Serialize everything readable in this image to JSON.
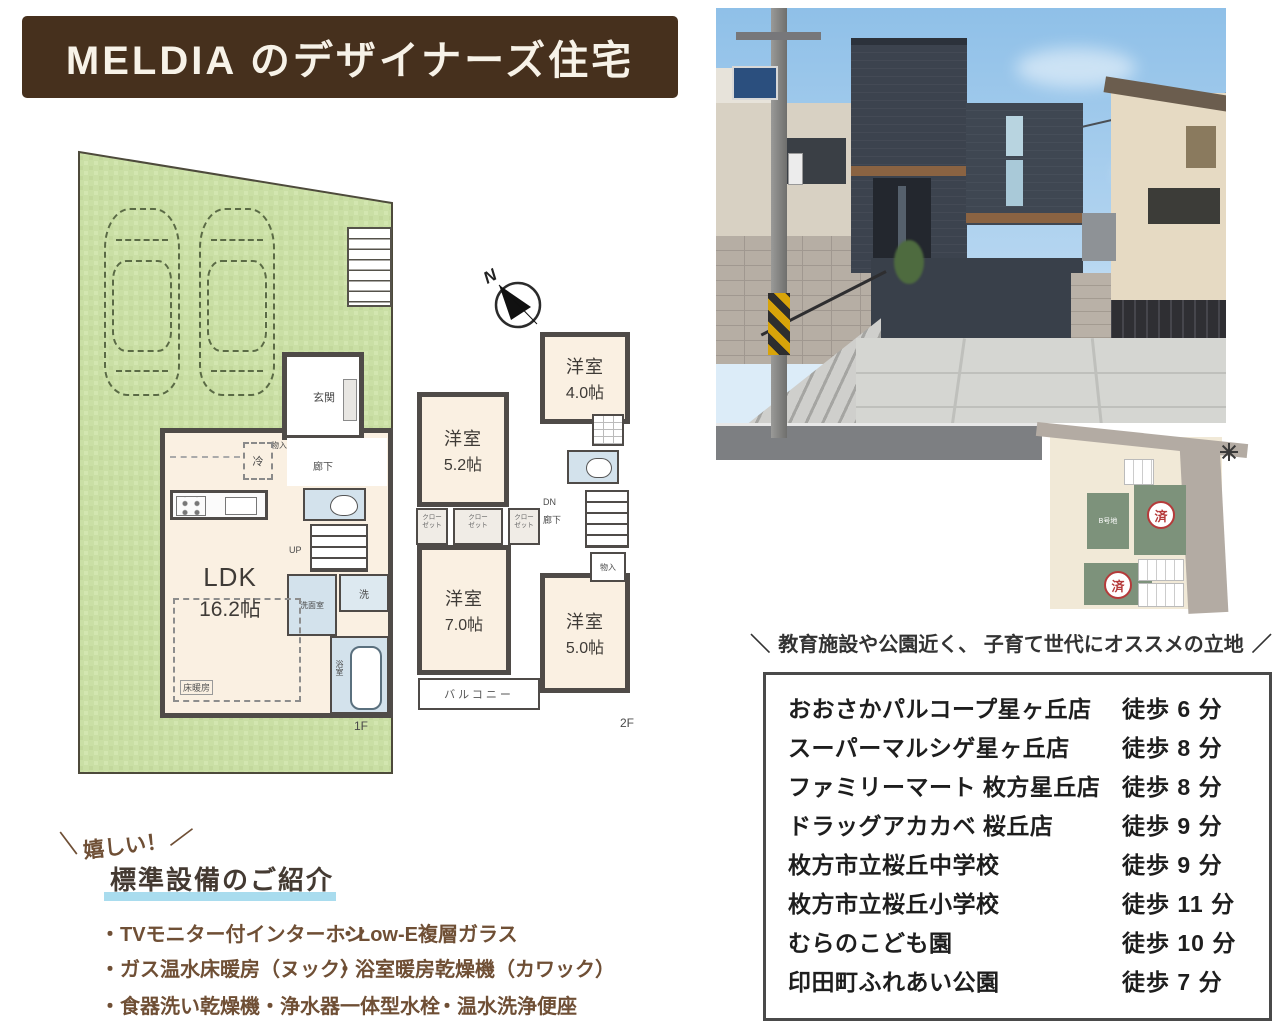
{
  "banner": {
    "title": "MELDIA のデザイナーズ住宅"
  },
  "compass": {
    "north": "N"
  },
  "floor1": {
    "floor_label": "1F",
    "ldk": {
      "name": "LDK",
      "size": "16.2帖"
    },
    "entrance": "玄関",
    "hallway": "廊下",
    "storage": "物入",
    "fridge": "冷",
    "up": "UP",
    "washroom": "洗面室",
    "washer": "洗",
    "bath": "浴室",
    "floor_heating": "床暖房"
  },
  "floor2": {
    "floor_label": "2F",
    "rooms": [
      {
        "name": "洋室",
        "size": "4.0帖"
      },
      {
        "name": "洋室",
        "size": "5.2帖"
      },
      {
        "name": "洋室",
        "size": "7.0帖"
      },
      {
        "name": "洋室",
        "size": "5.0帖"
      }
    ],
    "down": "DN",
    "hallway": "廊下",
    "storage": "物入",
    "closet": {
      "line1": "クロー",
      "line2": "ゼット"
    },
    "balcony": "バルコニー"
  },
  "site_mini_map": {
    "lot_label": "B号地",
    "sold_stamp": "済"
  },
  "tagline": {
    "slash_left": "＼",
    "text": "教育施設や公園近く、 子育て世代にオススメの立地",
    "slash_right": "／"
  },
  "facilities": {
    "items": [
      {
        "name": "おおさかパルコープ星ヶ丘店",
        "time": "徒歩 6 分"
      },
      {
        "name": "スーパーマルシゲ星ヶ丘店",
        "time": "徒歩 8 分"
      },
      {
        "name": "ファミリーマート 枚方星丘店",
        "time": "徒歩 8 分"
      },
      {
        "name": "ドラッグアカカベ 桜丘店",
        "time": "徒歩 9 分"
      },
      {
        "name": "枚方市立桜丘中学校",
        "time": "徒歩 9 分"
      },
      {
        "name": "枚方市立桜丘小学校",
        "time": "徒歩 11 分"
      },
      {
        "name": "むらのこども園",
        "time": "徒歩 10 分"
      },
      {
        "name": "印田町ふれあい公園",
        "time": "徒歩 7 分"
      }
    ]
  },
  "equipment": {
    "callout": {
      "slash_left": "＼",
      "text": "嬉しい！",
      "slash_right": "／"
    },
    "heading": "標準設備のご紹介",
    "items": [
      "・TVモニター付インターホン",
      "・Low-E複層ガラス",
      "・ガス温水床暖房（ヌック）",
      "・浴室暖房乾燥機（カワック）",
      "・食器洗い乾燥機・浄水器一体型水栓",
      "・温水洗浄便座"
    ]
  },
  "colors": {
    "banner_bg": "#46301d",
    "yard_green": "#cadfa5",
    "room_cream": "#faf0e2",
    "wet_blue": "#d3e2ec",
    "wall": "#4f4b48",
    "accent_brown": "#6f4f35",
    "underline_blue": "#a9dcee",
    "sold_red": "#b53a3a"
  }
}
